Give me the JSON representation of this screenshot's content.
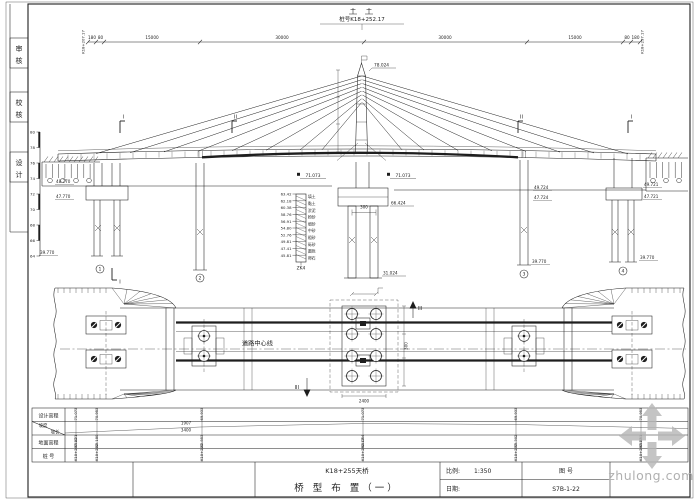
{
  "colors": {
    "ink": "#1e1e1e",
    "paper": "#ffffff",
    "watermark": "#b0b0b0"
  },
  "margin_boxes": [
    "审核",
    "校核",
    "设计"
  ],
  "elevation": {
    "center_note": "桩号K18+252.17",
    "dim_ticks": [
      88,
      96,
      104,
      200,
      364,
      527,
      623,
      631,
      640
    ],
    "dim_labels": [
      {
        "x": 92,
        "t": "180"
      },
      {
        "x": 100.5,
        "t": "80"
      },
      {
        "x": 152,
        "t": "15000"
      },
      {
        "x": 282,
        "t": "30000"
      },
      {
        "x": 445,
        "t": "30000"
      },
      {
        "x": 575,
        "t": "15000"
      },
      {
        "x": 627,
        "t": "80"
      },
      {
        "x": 635.5,
        "t": "180"
      }
    ],
    "station_left": "K18+207.17",
    "station_right": "K18+297.17",
    "ruler_values": [
      "80",
      "78",
      "76",
      "74",
      "72",
      "70",
      "68",
      "66",
      "64"
    ],
    "pylon_top_elev": "78.024",
    "deck_elev_left": "71.073",
    "deck_elev_right": "71.073",
    "cap_elev": "66.424",
    "cap_dim": "300",
    "pile_elev": "31.024",
    "pier_elev_labels": [
      {
        "x": 56,
        "y": 183,
        "t": "48.770"
      },
      {
        "x": 56,
        "y": 198,
        "t": "47.770"
      },
      {
        "x": 40,
        "y": 254,
        "t": "39.770"
      },
      {
        "x": 534,
        "y": 189,
        "t": "49.724"
      },
      {
        "x": 534,
        "y": 199,
        "t": "47.724"
      },
      {
        "x": 532,
        "y": 263,
        "t": "39.770"
      },
      {
        "x": 644,
        "y": 186,
        "t": "49.721"
      },
      {
        "x": 644,
        "y": 198,
        "t": "47.721"
      },
      {
        "x": 640,
        "y": 259,
        "t": "39.770"
      }
    ],
    "pier_numbers": [
      {
        "x": 100,
        "y": 269,
        "n": "1"
      },
      {
        "x": 200,
        "y": 278,
        "n": "2"
      },
      {
        "x": 524,
        "y": 274,
        "n": "3"
      },
      {
        "x": 623,
        "y": 271,
        "n": "4"
      }
    ],
    "section_markers_top": [
      {
        "x": 120,
        "t": "I"
      },
      {
        "x": 232,
        "t": "II"
      },
      {
        "x": 518,
        "t": "II"
      },
      {
        "x": 628,
        "t": "I"
      }
    ],
    "section_markers_bottom": [
      {
        "x": 112,
        "t": "I"
      }
    ],
    "cables_left": [
      96,
      130,
      164,
      198,
      232,
      266,
      300,
      322
    ],
    "cables_right": [
      628,
      594,
      560,
      526,
      492,
      458,
      424,
      402
    ],
    "borehole": {
      "name": "ZK4",
      "layers": [
        {
          "elev": "63.42",
          "soil": "填土"
        },
        {
          "elev": "62.18",
          "soil": "黏土"
        },
        {
          "elev": "60.38",
          "soil": "淤泥"
        },
        {
          "elev": "58.76",
          "soil": "粉砂"
        },
        {
          "elev": "56.91",
          "soil": "细砂"
        },
        {
          "elev": "54.80",
          "soil": "中砂"
        },
        {
          "elev": "52.76",
          "soil": "粗砂"
        },
        {
          "elev": "49.81",
          "soil": "砾砂"
        },
        {
          "elev": "47.41",
          "soil": "圆砾"
        },
        {
          "elev": "45.81",
          "soil": "卵石"
        }
      ]
    }
  },
  "plan": {
    "centerline_label": "道路中心线",
    "section_arrow_label": "III",
    "side_dim": "300",
    "bottom_dim": "2400"
  },
  "profile": {
    "row_labels": {
      "r1": "设计高程",
      "r2a": "坡度",
      "r2b": "坡长",
      "r3": "地面高程",
      "r4": "桩  号"
    },
    "grade_top": "1907",
    "grade_bottom": "3400",
    "columns": [
      {
        "x": 76,
        "design": "71.073",
        "ground": "63.421",
        "station": "K18+207.17"
      },
      {
        "x": 97,
        "design": "70.953",
        "ground": "63.180",
        "station": "K18+212"
      },
      {
        "x": 202,
        "design": "69.933",
        "ground": "62.853",
        "station": "K18+227"
      },
      {
        "x": 363,
        "design": "71.073",
        "ground": "63.054",
        "station": "K18+252.17"
      },
      {
        "x": 516,
        "design": "69.933",
        "ground": "63.302",
        "station": "K18+277"
      },
      {
        "x": 641,
        "design": "70.953",
        "ground": "63.551",
        "station": "K18+297.17"
      }
    ]
  },
  "titleblock": {
    "project": "K18+255天桥",
    "sheet_title": "桥 型 布 置（一）",
    "scale_label": "比例:",
    "scale_value": "1:350",
    "date_label": "日期:",
    "figno_label": "图 号",
    "figno": "S7B-1-22"
  },
  "watermark": {
    "text": "zhulong.com"
  }
}
